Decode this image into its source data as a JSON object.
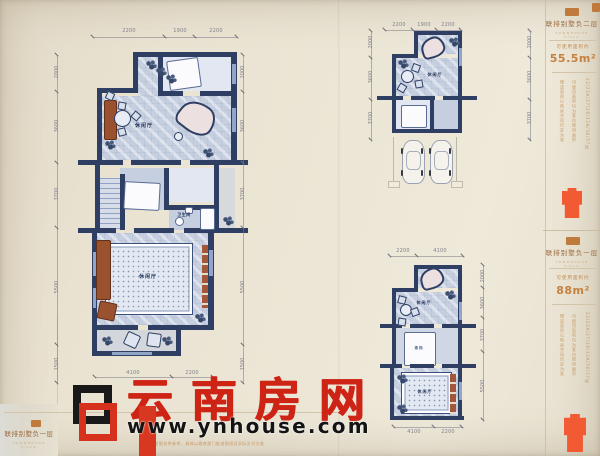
{
  "watermark": {
    "chars": [
      "云",
      "南",
      "房",
      "网"
    ],
    "url": "www.ynhouse.com",
    "brand_red": "#ce2416"
  },
  "left_page": {
    "title_block": {
      "title": "联排别墅负一层",
      "subtitle": "TOWNHOUSE VILLA"
    },
    "disclaimer": "户型图仅供参考，具体以政府部门批准图纸及实际交付为准",
    "plan_main": {
      "room_labels": {
        "upper": "休闲厅",
        "bath": "卫生间",
        "lower": "休闲厅"
      },
      "dims_top": [
        "2200",
        "1900",
        "2200"
      ],
      "dims_left": [
        "2000",
        "3600",
        "3700",
        "5500",
        "1500"
      ],
      "dims_right": [
        "2000",
        "3600",
        "3700",
        "5500",
        "1500"
      ],
      "dims_bottom": [
        "4100",
        "2200"
      ]
    }
  },
  "right_page": {
    "plan_upper": {
      "room_label": "休闲厅",
      "dims_top": [
        "2200",
        "1900",
        "2200"
      ],
      "dims_left": [
        "2000",
        "3600",
        "3700"
      ],
      "dims_right": [
        "2000",
        "3600",
        "3700"
      ]
    },
    "plan_lower": {
      "room_labels": {
        "upper": "休闲厅",
        "stairs": "楼梯",
        "lower": "休闲厅"
      },
      "dims_top": [
        "2200",
        "4100"
      ],
      "dims_right": [
        "2000",
        "3600",
        "3700",
        "5500"
      ],
      "dims_bottom": [
        "4100",
        "2200"
      ]
    },
    "sidebar": {
      "block1": {
        "title": "联排别墅负二层",
        "subtitle": "TOWNHOUSE VILLA",
        "area_label": "可使用面积约",
        "area_value": "55.5m²",
        "note_a": "可使用面积均为套内使用面积",
        "note_b": "赠送面积以购房合同约定为准",
        "units": "22/23A/27/28/33A/36/37栋"
      },
      "block2": {
        "title": "联排别墅负一层",
        "subtitle": "TOWNHOUSE VILLA",
        "area_label": "可使用面积约",
        "area_value": "88m²",
        "note_a": "可使用面积均为套内使用面积",
        "note_b": "赠送面积以购房合同约定为准",
        "units": "22/23A/27/28/33A/36/37栋"
      }
    }
  },
  "colors": {
    "accent_orange": "#c07a3c",
    "icon_orange": "#f15a33",
    "wall_navy": "#2e3f63",
    "paper": "#ece6d6"
  }
}
